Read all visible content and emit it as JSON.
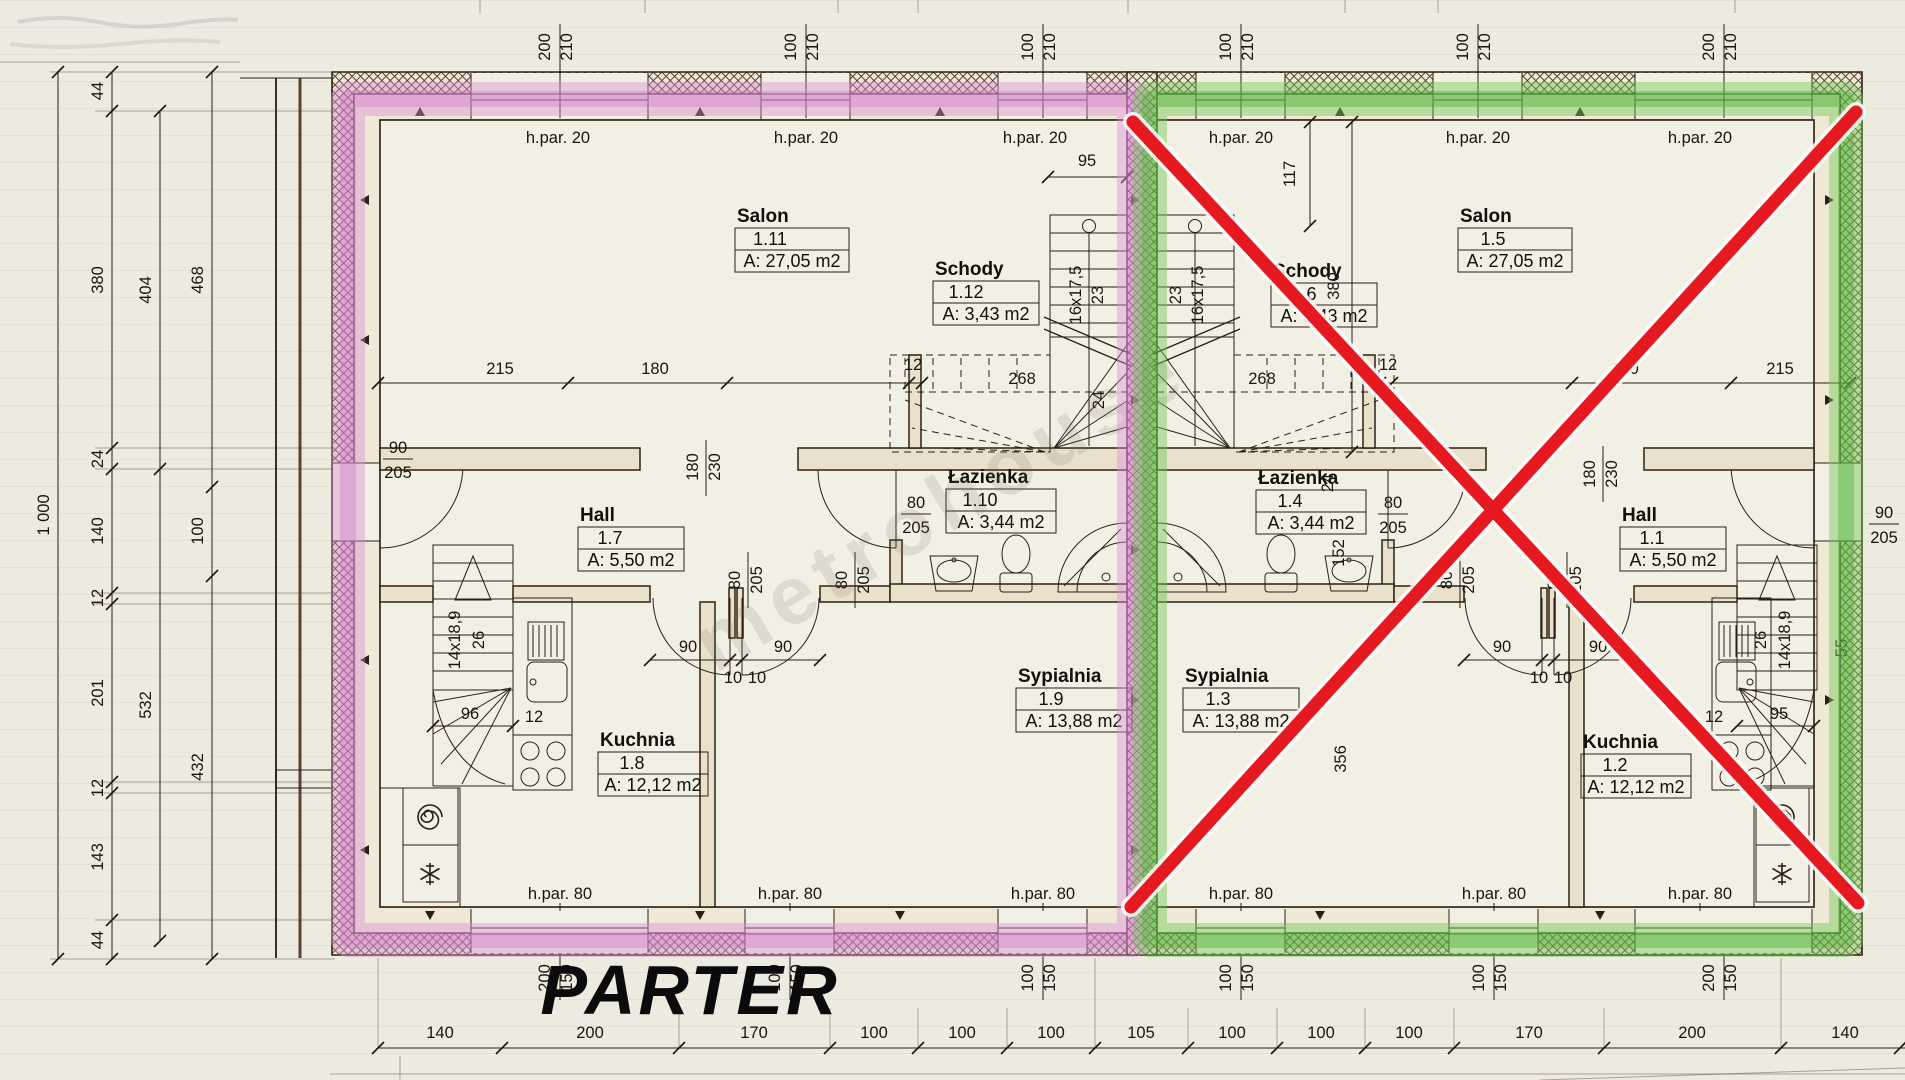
{
  "title": "PARTER",
  "watermark": "metrohouse",
  "common": {
    "hpar20": "h.par. 20",
    "hpar80": "h.par. 80"
  },
  "rooms": [
    {
      "name": "Salon",
      "number": "1.11",
      "area": "A: 27,05 m2"
    },
    {
      "name": "Schody",
      "number": "1.12",
      "area": "A: 3,43 m2"
    },
    {
      "name": "Hall",
      "number": "1.7",
      "area": "A: 5,50 m2"
    },
    {
      "name": "Łazienka",
      "number": "1.10",
      "area": "A: 3,44 m2"
    },
    {
      "name": "Sypialnia",
      "number": "1.9",
      "area": "A: 13,88 m2"
    },
    {
      "name": "Kuchnia",
      "number": "1.8",
      "area": "A: 12,12 m2"
    },
    {
      "name": "Salon",
      "number": "1.5",
      "area": "A: 27,05 m2"
    },
    {
      "name": "Schody",
      "number": "1.6",
      "area": "A: 3,43 m2"
    },
    {
      "name": "Hall",
      "number": "1.1",
      "area": "A: 5,50 m2"
    },
    {
      "name": "Łazienka",
      "number": "1.4",
      "area": "A: 3,44 m2"
    },
    {
      "name": "Sypialnia",
      "number": "1.3",
      "area": "A: 13,88 m2"
    },
    {
      "name": "Kuchnia",
      "number": "1.2",
      "area": "A: 12,12 m2"
    }
  ],
  "top_windows": [
    {
      "w": "200",
      "h": "210"
    },
    {
      "w": "100",
      "h": "210"
    },
    {
      "w": "100",
      "h": "210"
    },
    {
      "w": "100",
      "h": "210"
    },
    {
      "w": "100",
      "h": "210"
    },
    {
      "w": "200",
      "h": "210"
    }
  ],
  "bottom_windows": [
    {
      "w": "200",
      "h": "150"
    },
    {
      "w": "100",
      "h": "150"
    },
    {
      "w": "100",
      "h": "150"
    },
    {
      "w": "100",
      "h": "150"
    },
    {
      "w": "100",
      "h": "150"
    },
    {
      "w": "200",
      "h": "150"
    }
  ],
  "left_chain_inner": [
    "44",
    "380",
    "24",
    "140",
    "12",
    "201",
    "12",
    "143",
    "44"
  ],
  "left_chain_mid": [
    "404",
    "532"
  ],
  "left_chain_outer": [
    "468",
    "100",
    "432"
  ],
  "left_total": "1 000",
  "bottom_chain": [
    "140",
    "200",
    "170",
    "100",
    "100",
    "100",
    "105",
    "100",
    "100",
    "100",
    "170",
    "200",
    "140"
  ],
  "dims": {
    "salon_left": [
      "215",
      "180",
      "12"
    ],
    "salon_right": [
      "12",
      "180",
      "215"
    ],
    "stair_run": "95",
    "right_117": "117",
    "right_380": "380",
    "flight": "268",
    "main_stair_steps": "16x17,5",
    "main_stair_width": "23",
    "base_stair_steps": "14x18,9",
    "base_stair_width": "26",
    "opening_w": "180",
    "opening_h": "230",
    "door80_w": "80",
    "door80_h": "205",
    "door90_w": "90",
    "door90_h": "205",
    "swing": "90",
    "post": "10",
    "bath_24": "24",
    "bath_152": "152",
    "syp_356": "356",
    "base_run_left": "96",
    "base_run_right": "95",
    "counter_12": "12",
    "right_55": "55"
  }
}
